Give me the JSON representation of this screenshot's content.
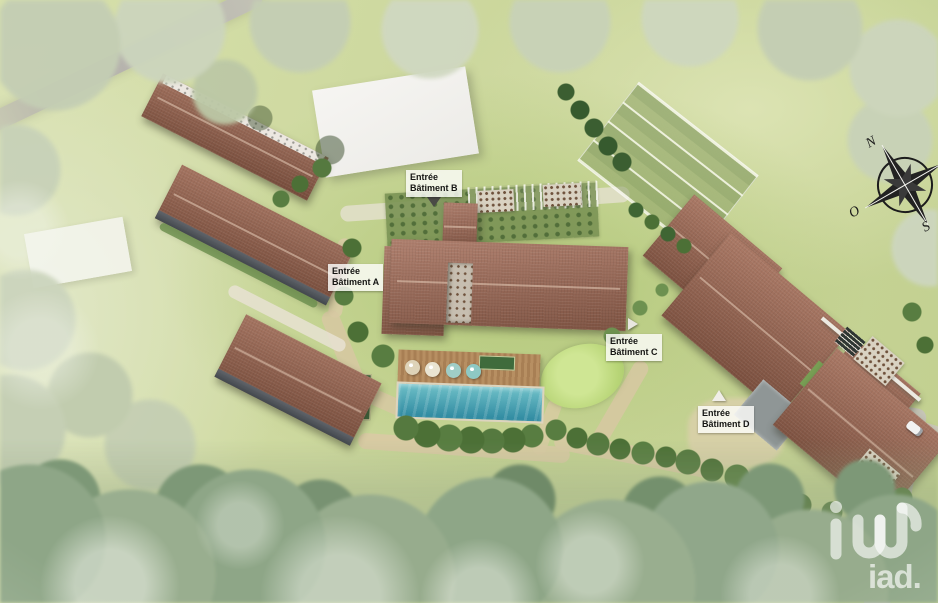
{
  "annotations": {
    "entrance_a": {
      "line1": "Entrée",
      "line2": "Bâtiment A"
    },
    "entrance_b": {
      "line1": "Entrée",
      "line2": "Bâtiment B"
    },
    "entrance_c": {
      "line1": "Entrée",
      "line2": "Bâtiment C"
    },
    "entrance_d": {
      "line1": "Entrée",
      "line2": "Bâtiment D"
    }
  },
  "compass": {
    "north": "N",
    "west": "O",
    "south": "S"
  },
  "watermark": {
    "brand": "iad."
  },
  "colors": {
    "roof_main": "#9c6a55",
    "pool_water": "#3d9cae",
    "grass": "#ccd89e",
    "path_sand": "#d5c49c",
    "road_gray": "#b7b4af",
    "tree_dark": "#4c7036",
    "label_bg": "#fcfcfa",
    "white_building": "#f3f2ee"
  }
}
